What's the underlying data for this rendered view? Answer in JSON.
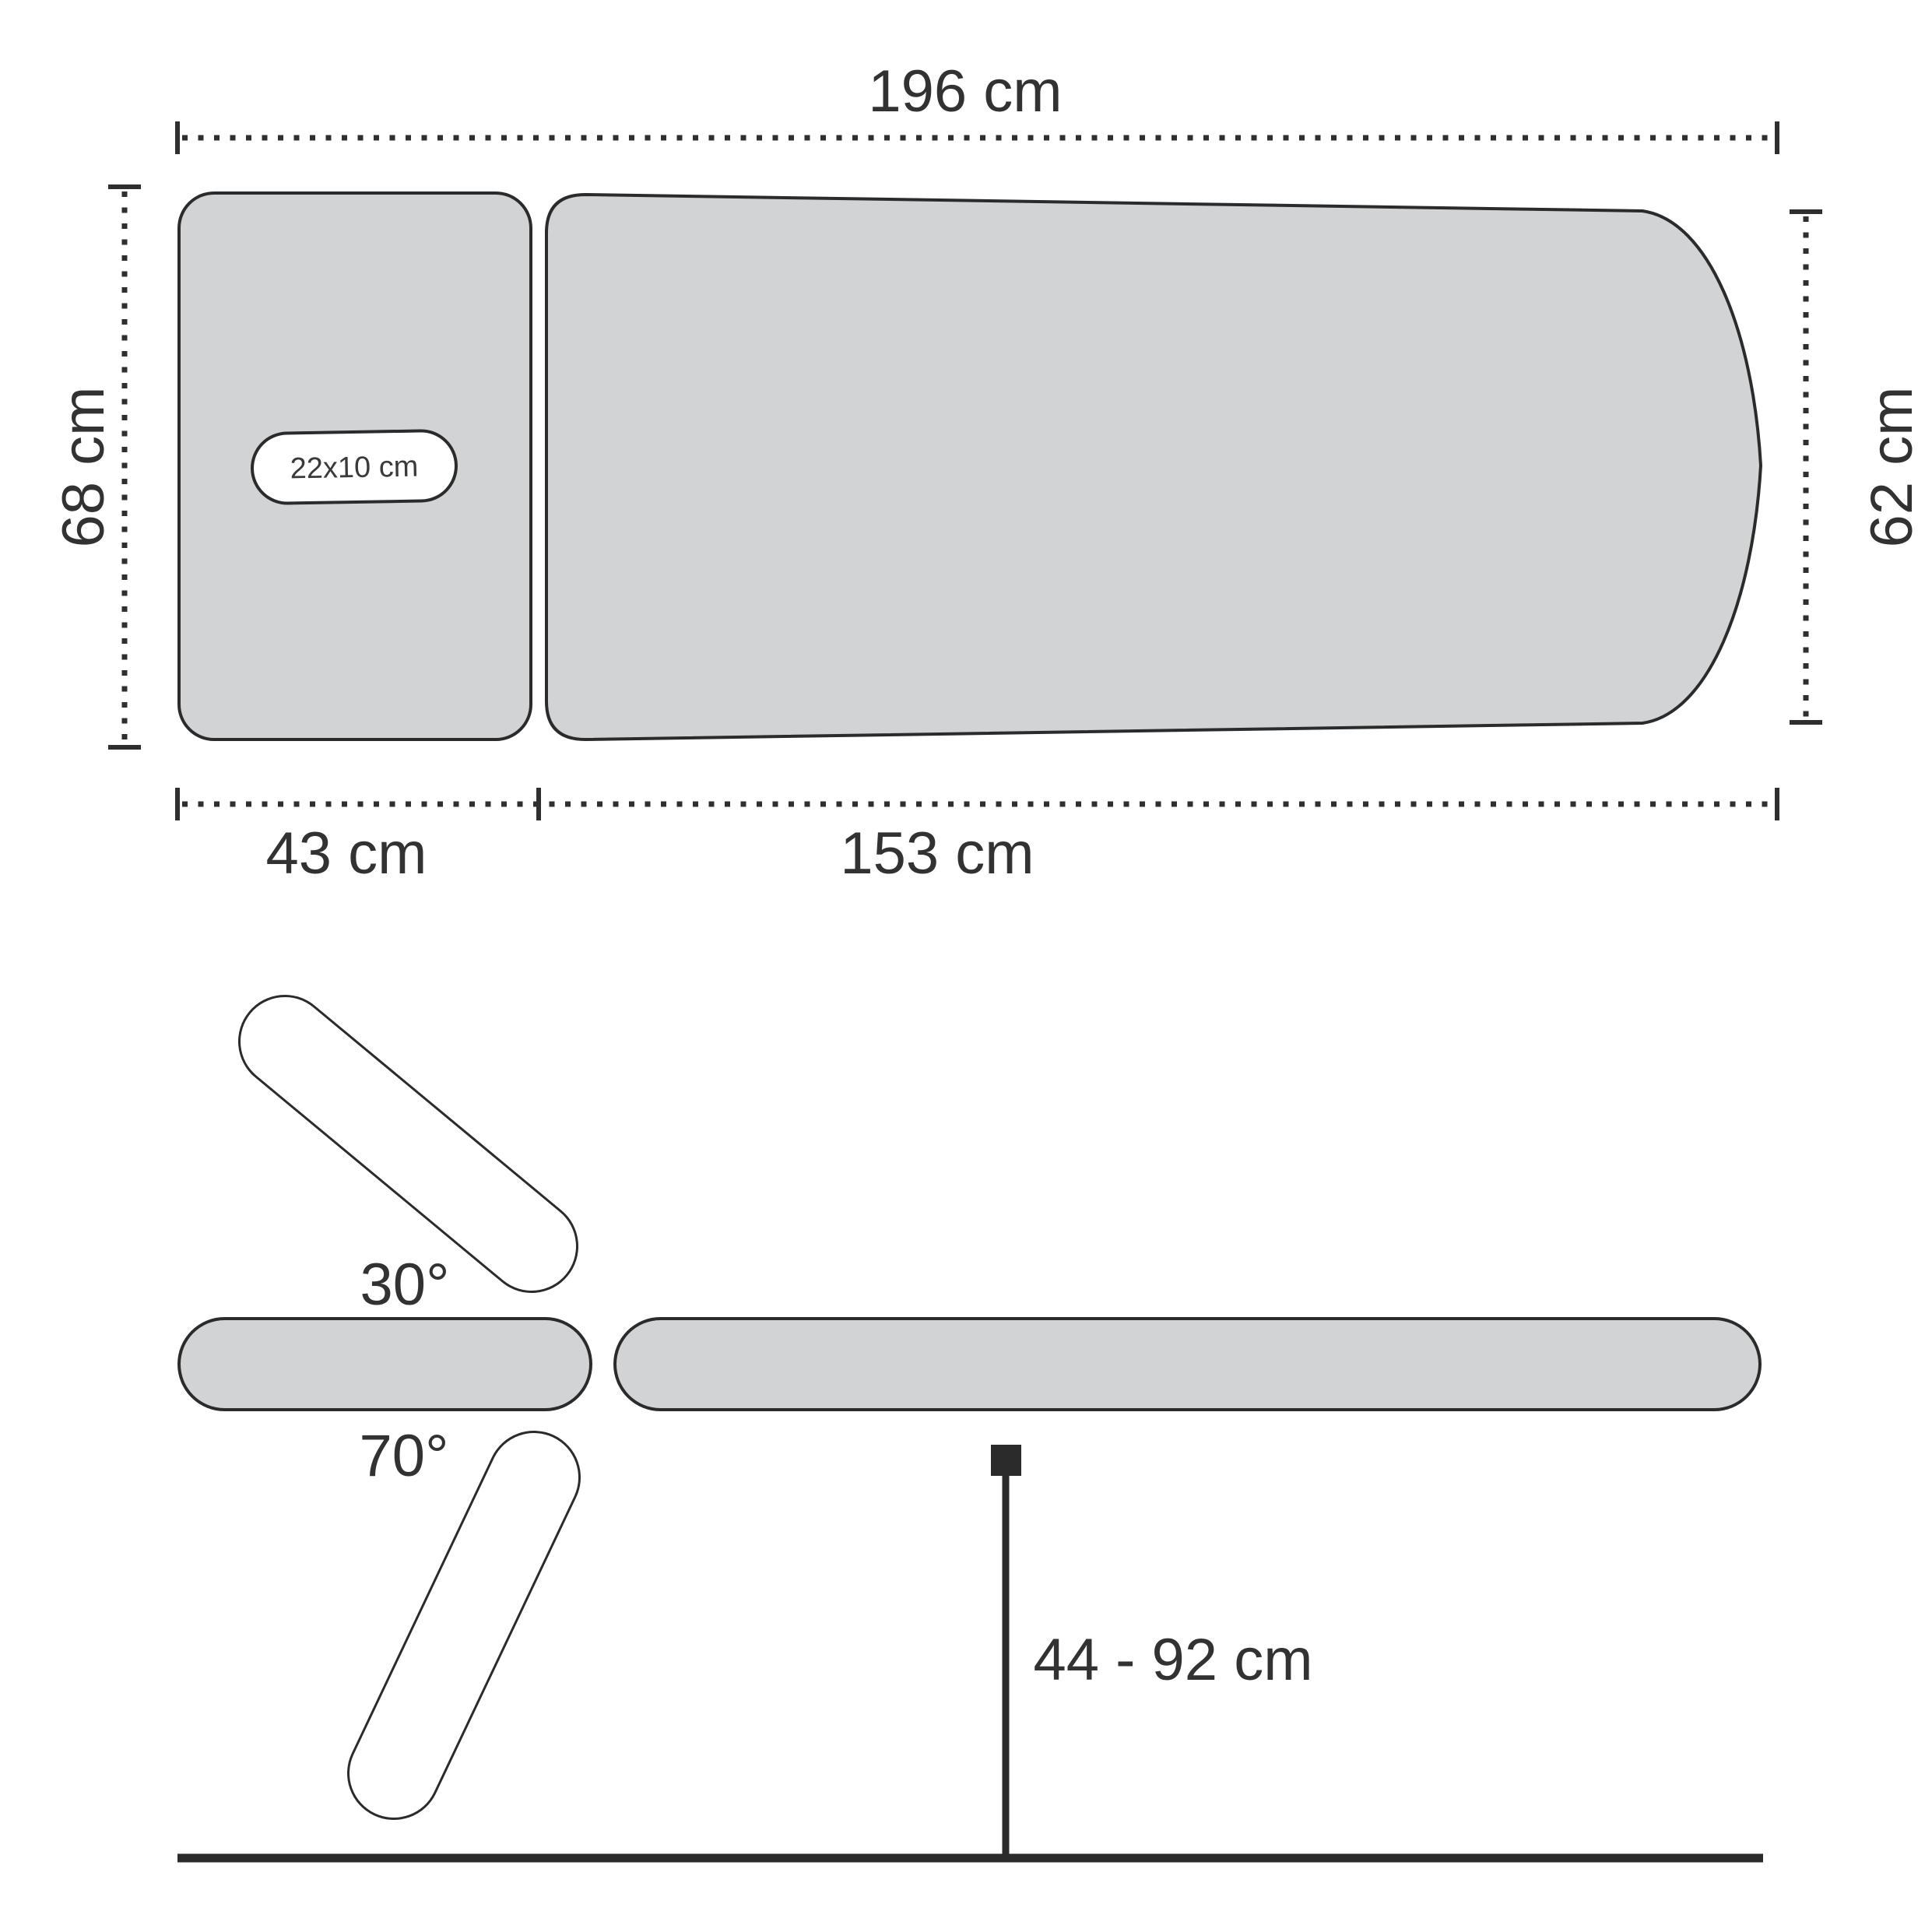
{
  "title": "Massage table dimensions diagram",
  "colors": {
    "background": "#ffffff",
    "surface_fill": "#d2d3d4",
    "outline": "#2b2b2b",
    "dimension_text": "#323232"
  },
  "top_view": {
    "total_length_label": "196 cm",
    "head_section_width_label": "68 cm",
    "foot_width_label": "62 cm",
    "head_section_length_label": "43 cm",
    "main_section_length_label": "153 cm",
    "face_hole_label": "22x10 cm"
  },
  "side_view": {
    "headrest_up_angle_label": "30°",
    "headrest_down_angle_label": "70°",
    "height_range_label": "44 - 92 cm"
  }
}
